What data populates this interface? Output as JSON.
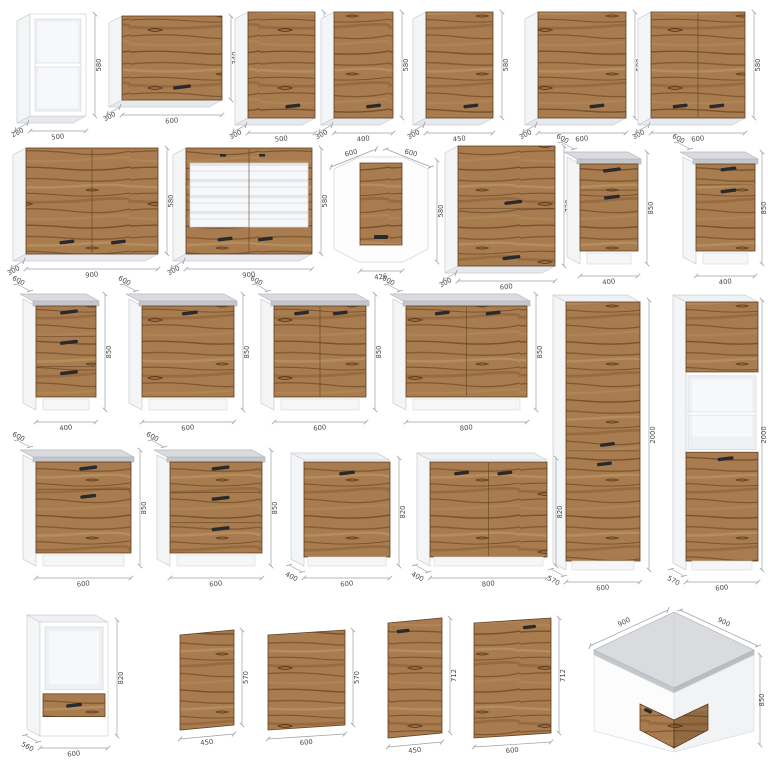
{
  "colors": {
    "wood": "#a87c4f",
    "woodStroke": "#5f4023",
    "side": "#f4f5f7",
    "sideDark": "#e7e9ec",
    "sideStroke": "#c9ccd0",
    "whiteStroke": "#cfd3d6",
    "counterTop": "#d9dbde",
    "counterEdge": "#c3c6ca",
    "counterStroke": "#b5b8bc",
    "niche": "#eef0f3",
    "nicheInner": "#f7f8fa",
    "handle": "#2a2a2c",
    "dim": "#9aa0a6",
    "dimText": "#4a4a4a"
  },
  "cabinets": [
    {
      "name": "open-shelf-500",
      "type": "open-box",
      "x": 30,
      "y": 14,
      "w": 56,
      "h": 102,
      "dims": {
        "w": "500",
        "h": "580",
        "d": "280"
      }
    },
    {
      "name": "wall-flip-600x340",
      "type": "wall-flip",
      "x": 122,
      "y": 16,
      "w": 100,
      "h": 84,
      "dims": {
        "w": "600",
        "h": "340",
        "d": "300"
      }
    },
    {
      "name": "wall-500",
      "type": "wall-door",
      "x": 248,
      "y": 12,
      "w": 67,
      "h": 106,
      "dims": {
        "w": "500",
        "h": "580",
        "d": "300"
      }
    },
    {
      "name": "wall-400",
      "type": "wall-door",
      "x": 334,
      "y": 12,
      "w": 59,
      "h": 106,
      "dims": {
        "w": "400",
        "h": "580",
        "d": "300"
      }
    },
    {
      "name": "wall-450",
      "type": "wall-door",
      "x": 426,
      "y": 12,
      "w": 67,
      "h": 106,
      "dims": {
        "w": "450",
        "h": "580",
        "d": "300"
      }
    },
    {
      "name": "wall-600",
      "type": "wall-door",
      "x": 538,
      "y": 12,
      "w": 88,
      "h": 106,
      "dims": {
        "w": "600",
        "h": "580",
        "d": "300"
      }
    },
    {
      "name": "wall-600-2door",
      "type": "wall-door2",
      "x": 651,
      "y": 12,
      "w": 94,
      "h": 106,
      "dims": {
        "w": "600",
        "h": "580",
        "d": "300"
      }
    },
    {
      "name": "wall-900-2door",
      "type": "wall-door2",
      "x": 26,
      "y": 148,
      "w": 132,
      "h": 106,
      "dims": {
        "w": "900",
        "h": "580",
        "d": "300"
      }
    },
    {
      "name": "wall-900-glass",
      "type": "wall-glass2",
      "x": 186,
      "y": 148,
      "w": 126,
      "h": 106,
      "dims": {
        "w": "900",
        "h": "580",
        "d": "300"
      }
    },
    {
      "name": "wall-corner-600",
      "type": "corner-wall",
      "x": 334,
      "y": 156,
      "w": 94,
      "h": 106,
      "dims": {
        "w": "426",
        "h": "580",
        "d1": "600",
        "d2": "600"
      }
    },
    {
      "name": "wall-600x720-flip",
      "type": "wall-flip2",
      "x": 458,
      "y": 146,
      "w": 97,
      "h": 120,
      "dims": {
        "w": "600",
        "h": "720",
        "d": "300"
      }
    },
    {
      "name": "base-400-drawer-door",
      "type": "base-drawer-door",
      "x": 580,
      "y": 164,
      "w": 58,
      "h": 100,
      "dims": {
        "w": "400",
        "h": "850",
        "d": "600"
      }
    },
    {
      "name": "base-400-drawer-door-2",
      "type": "base-drawer-door2",
      "x": 696,
      "y": 164,
      "w": 59,
      "h": 100,
      "dims": {
        "w": "400",
        "h": "850",
        "d": "600"
      }
    },
    {
      "name": "base-400-3drawer",
      "type": "base-3drawer",
      "x": 36,
      "y": 306,
      "w": 60,
      "h": 104,
      "dims": {
        "w": "400",
        "h": "850",
        "d": "600"
      }
    },
    {
      "name": "base-600-door",
      "type": "base-door1",
      "x": 142,
      "y": 306,
      "w": 92,
      "h": 104,
      "dims": {
        "w": "600",
        "h": "850",
        "d": "600"
      }
    },
    {
      "name": "base-600-2door",
      "type": "base-door2",
      "x": 274,
      "y": 306,
      "w": 92,
      "h": 104,
      "dims": {
        "w": "600",
        "h": "850",
        "d": "600"
      }
    },
    {
      "name": "base-800-2door",
      "type": "base-door2",
      "x": 406,
      "y": 306,
      "w": 121,
      "h": 104,
      "dims": {
        "w": "800",
        "h": "850",
        "d": "600"
      }
    },
    {
      "name": "tall-600",
      "type": "tall",
      "x": 566,
      "y": 302,
      "w": 74,
      "h": 268,
      "dims": {
        "w": "600",
        "h": "2000",
        "d": "570"
      }
    },
    {
      "name": "tall-oven-600",
      "type": "tall-oven",
      "x": 686,
      "y": 302,
      "w": 72,
      "h": 268,
      "dims": {
        "w": "600",
        "h": "2000",
        "d": "570"
      }
    },
    {
      "name": "base-600-drawer-door",
      "type": "base-drawer-door",
      "x": 36,
      "y": 462,
      "w": 95,
      "h": 104,
      "dims": {
        "w": "600",
        "h": "850",
        "d": "600"
      }
    },
    {
      "name": "base-600-3drawer",
      "type": "base-3drawer",
      "x": 170,
      "y": 462,
      "w": 92,
      "h": 104,
      "dims": {
        "w": "600",
        "h": "850",
        "d": "600"
      }
    },
    {
      "name": "appliance-600-door",
      "type": "appl-door1",
      "x": 304,
      "y": 460,
      "w": 86,
      "h": 106,
      "dims": {
        "w": "600",
        "h": "820",
        "d": "400"
      }
    },
    {
      "name": "appliance-800-2door",
      "type": "appl-door2",
      "x": 430,
      "y": 460,
      "w": 117,
      "h": 106,
      "dims": {
        "w": "800",
        "h": "820",
        "d": "400"
      }
    },
    {
      "name": "oven-housing-600",
      "type": "oven-base",
      "x": 40,
      "y": 622,
      "w": 68,
      "h": 114,
      "dims": {
        "w": "600",
        "h": "820",
        "d": "560"
      }
    },
    {
      "name": "front-450x570",
      "type": "panel",
      "x": 180,
      "y": 630,
      "w": 54,
      "h": 100,
      "dims": {
        "w": "450",
        "h": "570"
      }
    },
    {
      "name": "front-600x570",
      "type": "panel",
      "x": 268,
      "y": 630,
      "w": 77,
      "h": 100,
      "dims": {
        "w": "600",
        "h": "570"
      }
    },
    {
      "name": "front-450x712",
      "type": "panel-h-left",
      "x": 388,
      "y": 618,
      "w": 54,
      "h": 120,
      "dims": {
        "w": "450",
        "h": "712"
      }
    },
    {
      "name": "front-600x712",
      "type": "panel-h-right",
      "x": 474,
      "y": 618,
      "w": 77,
      "h": 120,
      "dims": {
        "w": "600",
        "h": "712"
      }
    },
    {
      "name": "base-corner-900",
      "type": "corner-base",
      "x": 594,
      "y": 612,
      "w": 160,
      "h": 140,
      "dims": {
        "w1": "900",
        "w2": "900",
        "h": "850"
      }
    }
  ]
}
